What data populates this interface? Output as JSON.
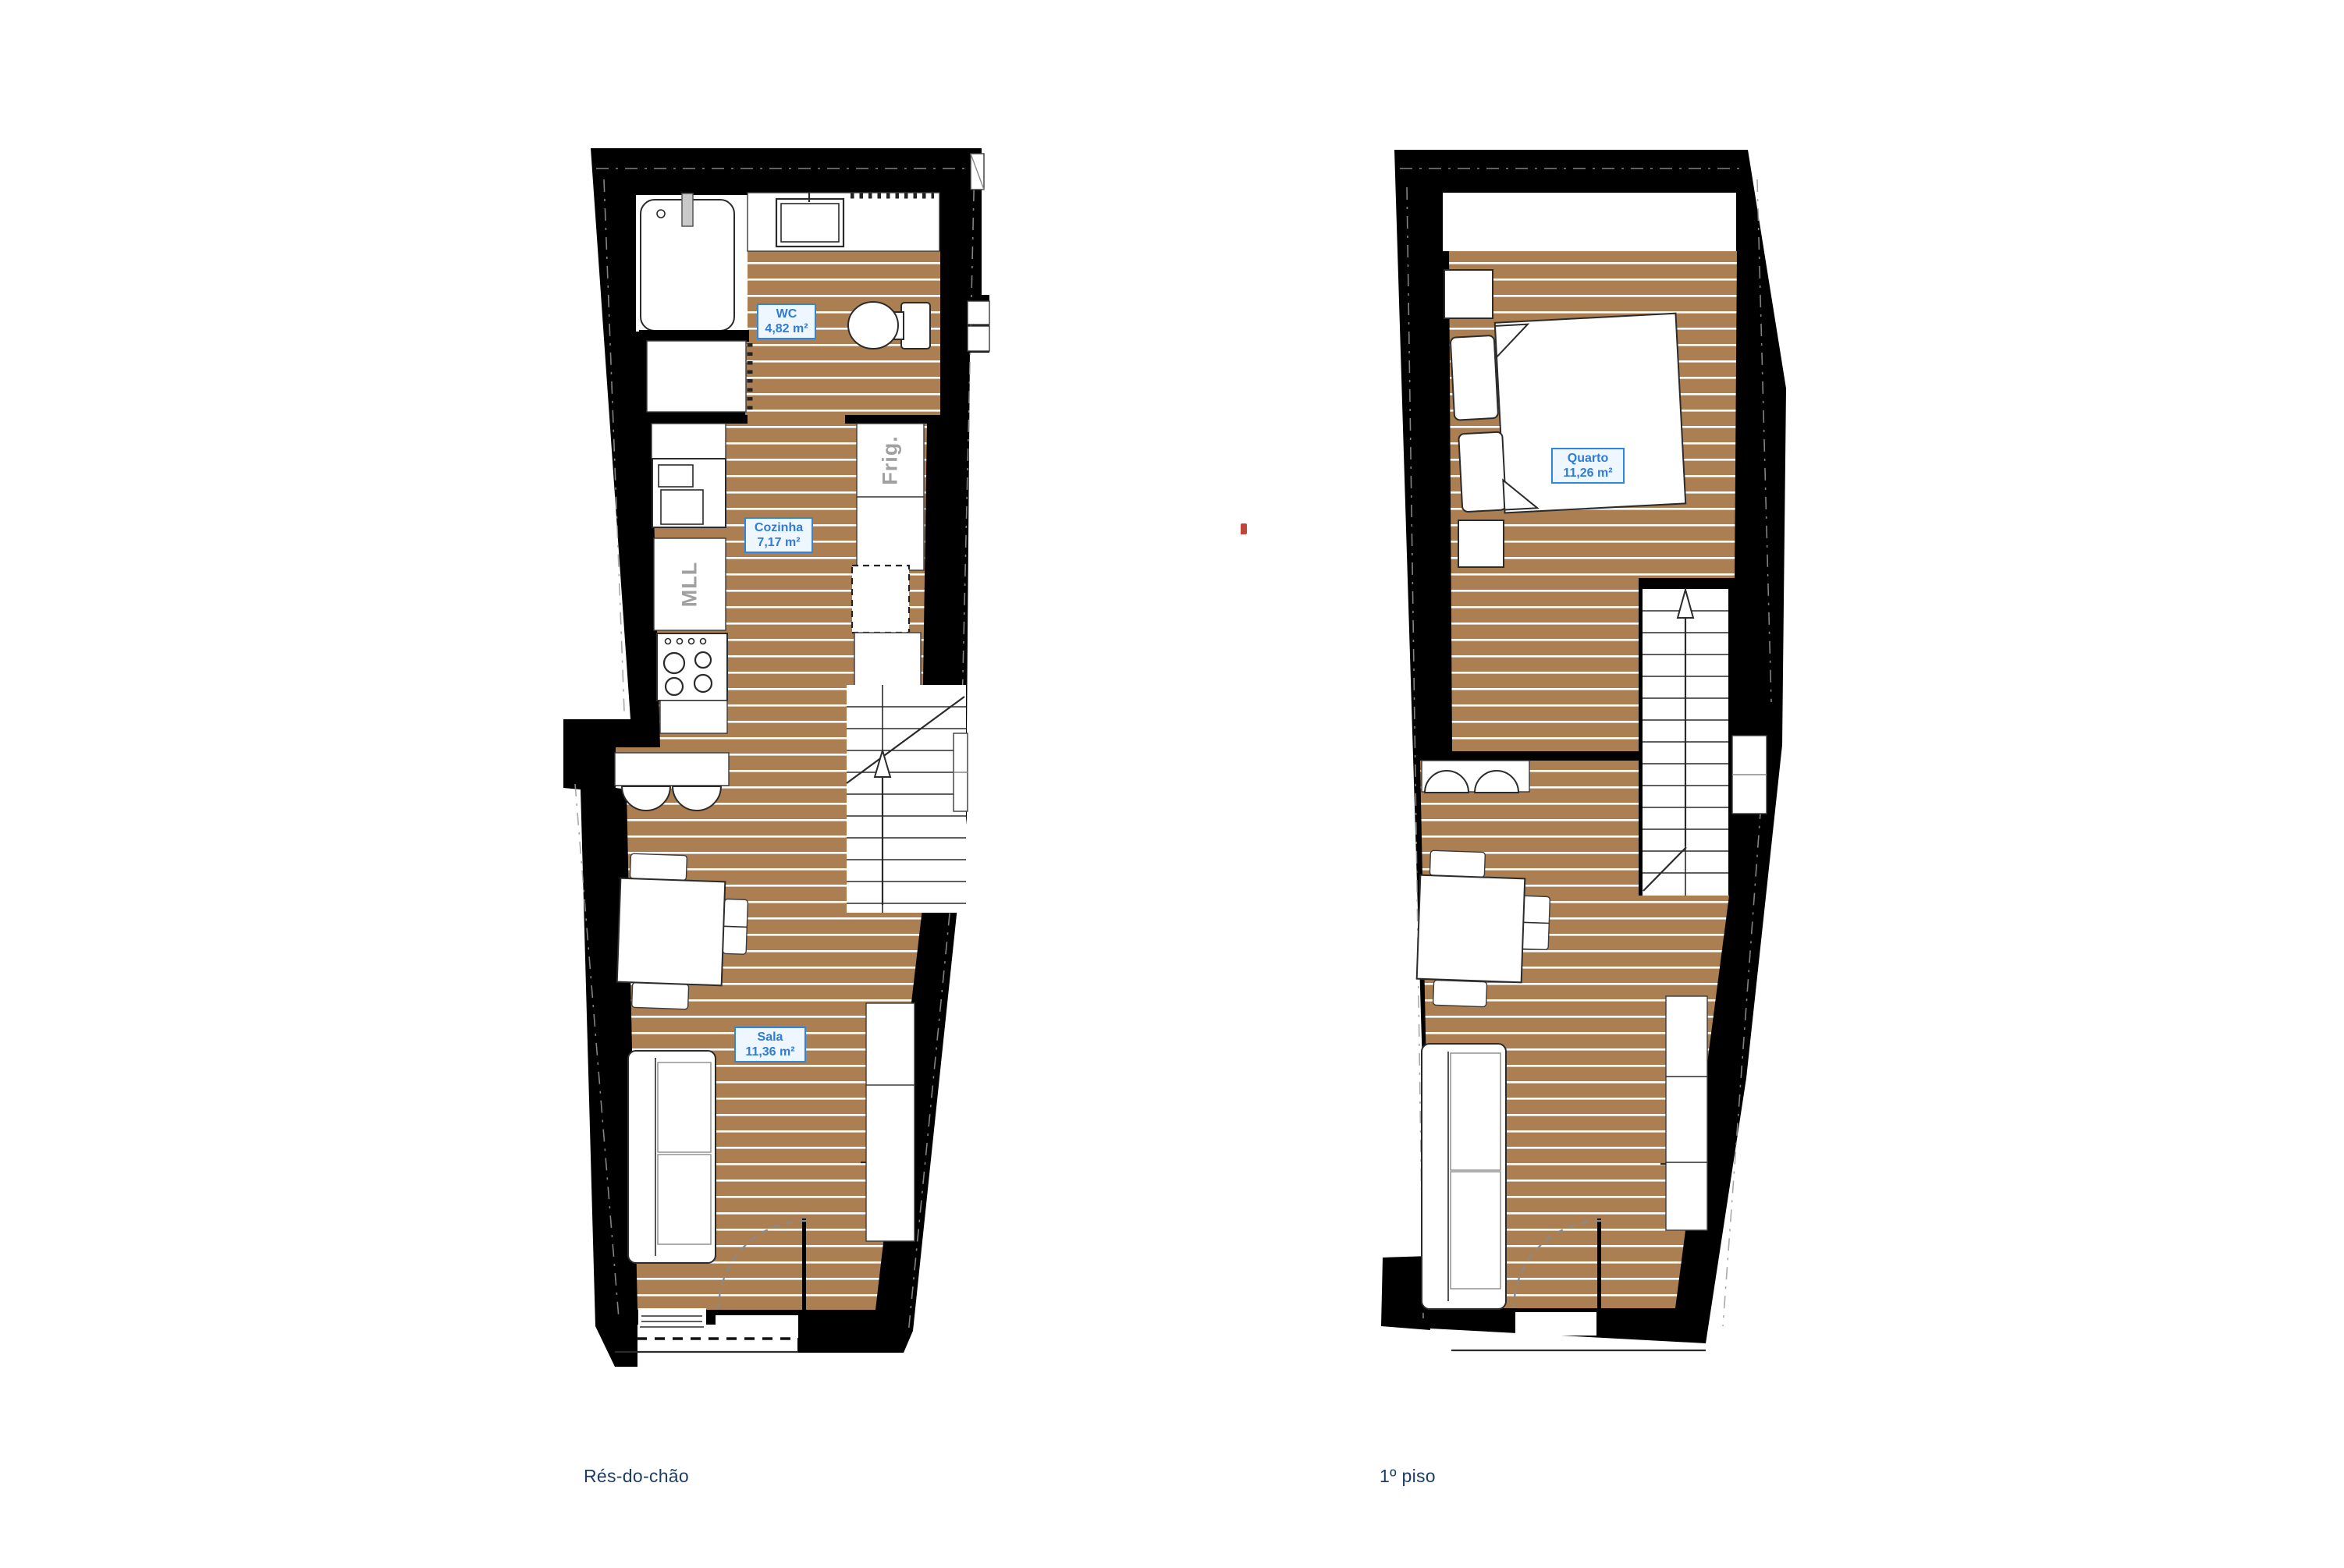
{
  "colors": {
    "wall": "#000000",
    "floor": "#ab7f51",
    "floor_stripe": "#ffffff",
    "furniture_fill": "#ffffff",
    "outline_dark": "#2b2b2b",
    "outline_gray": "#8a8a8a",
    "label_border": "#2e86de",
    "label_text": "#2e7cd6",
    "label_bg": "#eef6ff",
    "appliance_text": "#a0a0a0",
    "title_text": "#1f3d63",
    "artifact_red": "#c0453a"
  },
  "plans": [
    {
      "title": "Rés-do-chão",
      "rooms": [
        {
          "name": "WC",
          "area": "4,82 m²"
        },
        {
          "name": "Cozinha",
          "area": "7,17 m²"
        },
        {
          "name": "Sala",
          "area": "11,36 m²"
        }
      ],
      "appliances": [
        {
          "label": "MLL"
        },
        {
          "label": "Frig."
        }
      ]
    },
    {
      "title": "1º piso",
      "rooms": [
        {
          "name": "Quarto",
          "area": "11,26 m²"
        }
      ]
    }
  ]
}
